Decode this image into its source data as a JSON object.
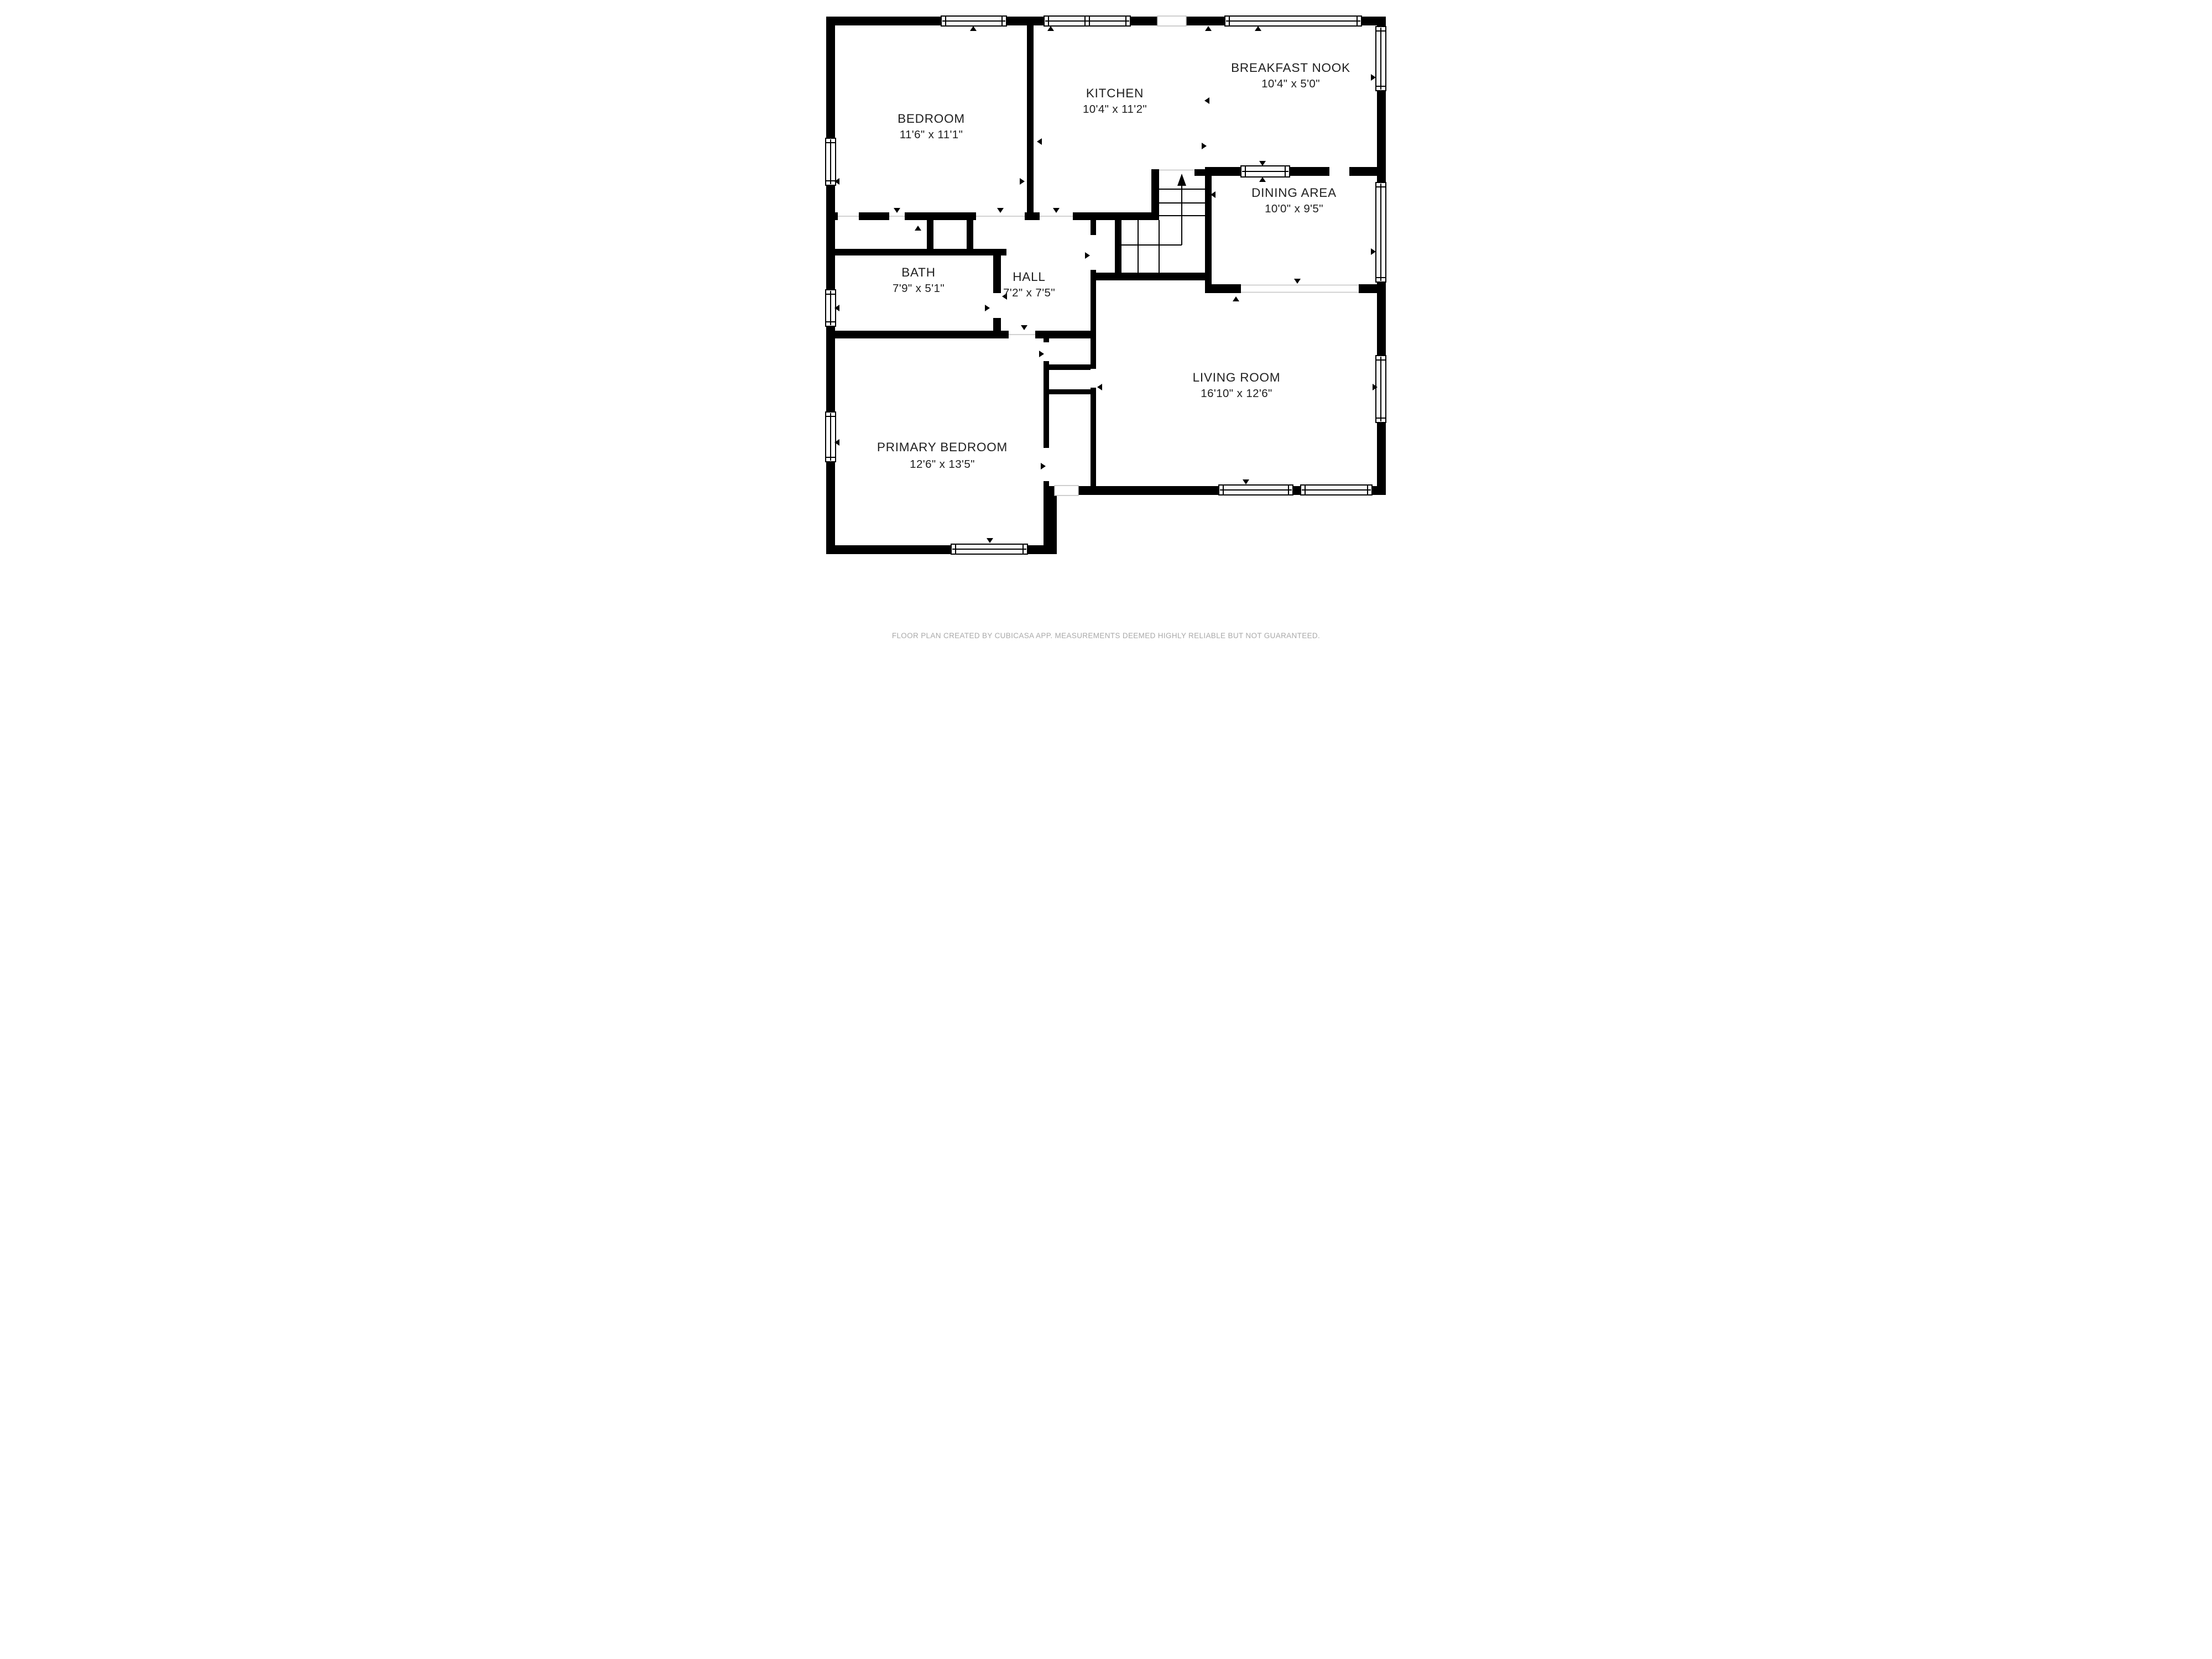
{
  "floorplan": {
    "rooms": [
      {
        "id": "bedroom",
        "name": "BEDROOM",
        "dims": "11'6\" x 11'1\""
      },
      {
        "id": "kitchen",
        "name": "KITCHEN",
        "dims": "10'4\" x 11'2\""
      },
      {
        "id": "breakfast-nook",
        "name": "BREAKFAST NOOK",
        "dims": "10'4\" x 5'0\""
      },
      {
        "id": "dining-area",
        "name": "DINING AREA",
        "dims": "10'0\" x 9'5\""
      },
      {
        "id": "bath",
        "name": "BATH",
        "dims": "7'9\" x 5'1\""
      },
      {
        "id": "hall",
        "name": "HALL",
        "dims": "7'2\" x 7'5\""
      },
      {
        "id": "living-room",
        "name": "LIVING ROOM",
        "dims": "16'10\" x 12'6\""
      },
      {
        "id": "primary-bedroom",
        "name": "PRIMARY BEDROOM",
        "dims": "12'6\" x 13'5\""
      }
    ],
    "stairs": {
      "direction_icon": "up-arrow"
    },
    "colors": {
      "wall": "#000000",
      "background": "#ffffff",
      "room_text": "#1f1f1f",
      "footer_text": "#a9a9a9"
    },
    "footer": "FLOOR PLAN CREATED BY CUBICASA APP. MEASUREMENTS DEEMED HIGHLY RELIABLE BUT NOT GUARANTEED."
  }
}
